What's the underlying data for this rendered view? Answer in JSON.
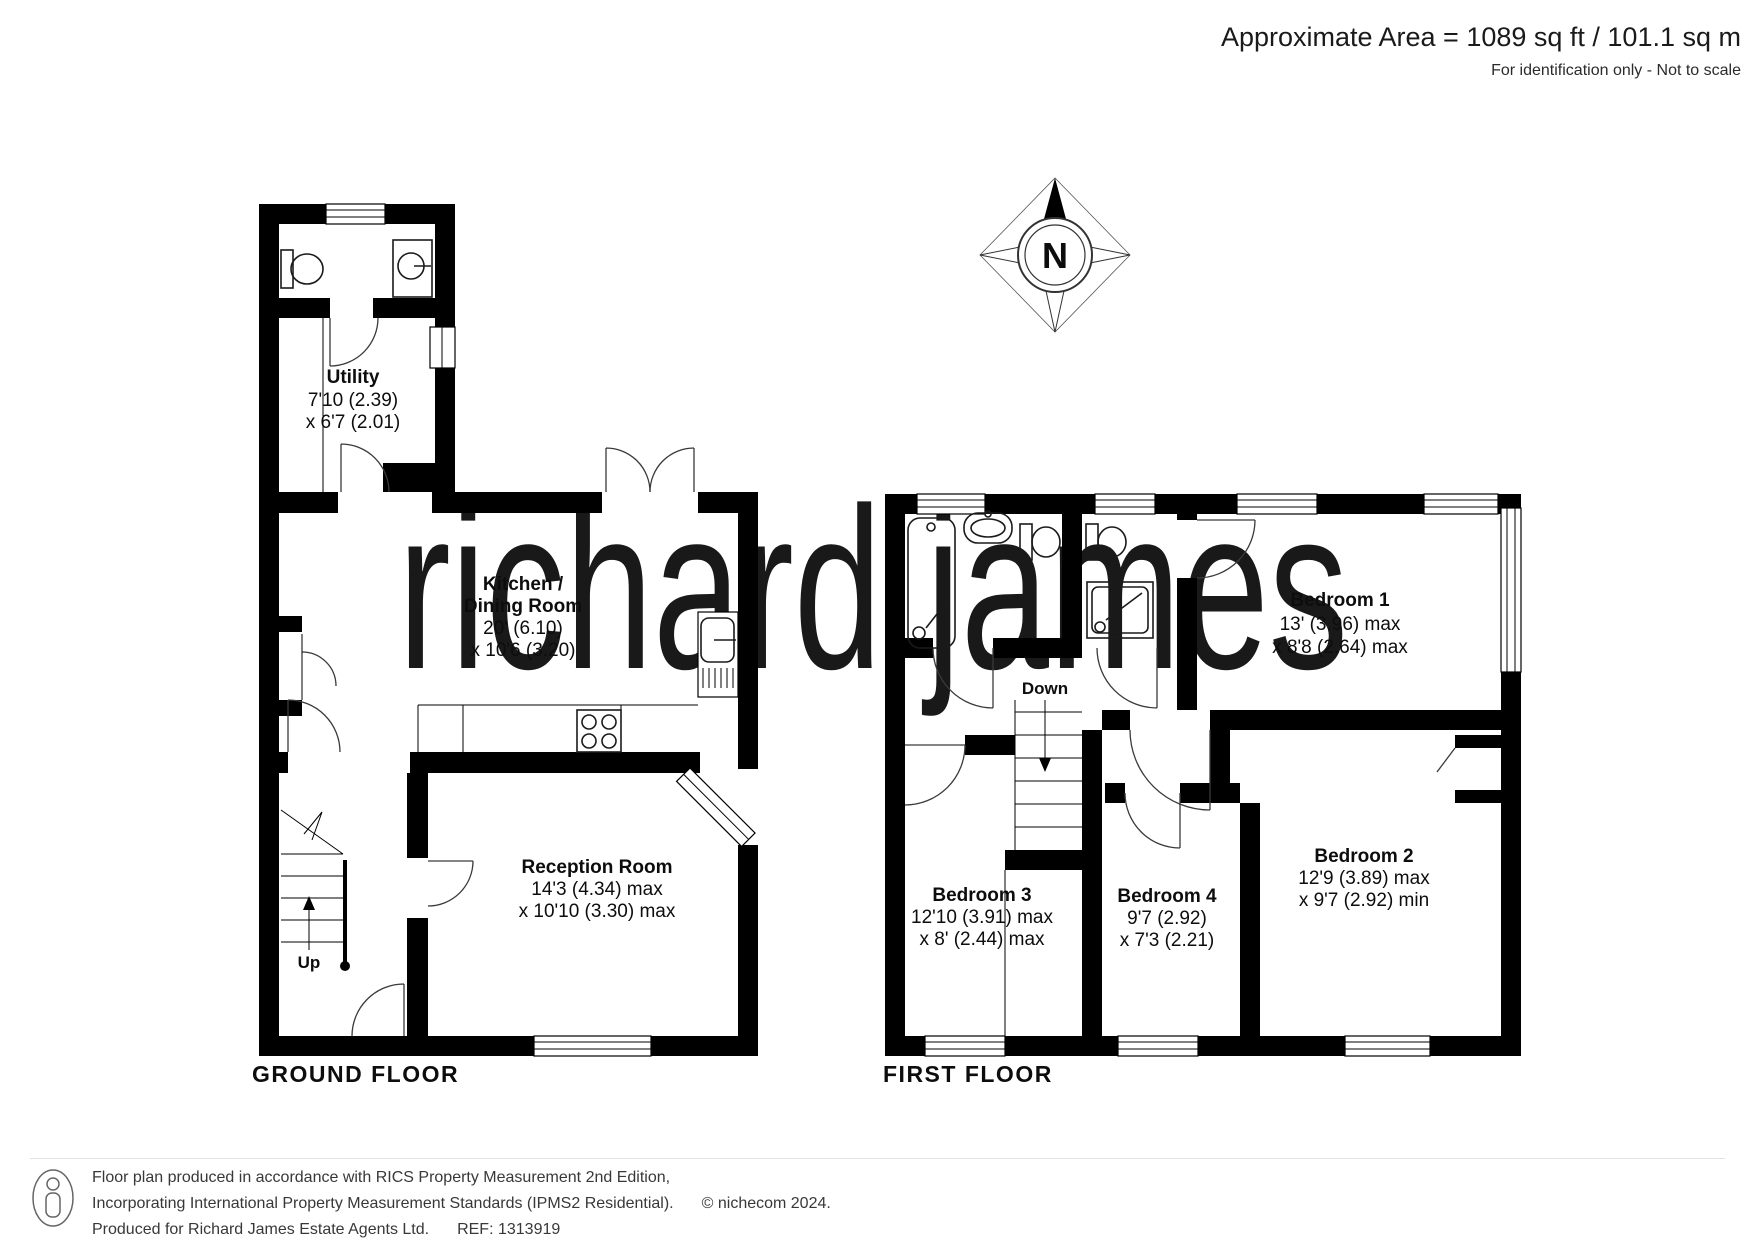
{
  "header": {
    "area": "Approximate Area = 1089 sq ft / 101.1 sq m",
    "note": "For identification only - Not to scale"
  },
  "compass": {
    "north": "N"
  },
  "watermark": {
    "text": "richard james"
  },
  "floors": {
    "ground": {
      "title": "GROUND FLOOR",
      "stairs_label": "Up",
      "rooms": {
        "utility": {
          "name": "Utility",
          "dim1": "7'10 (2.39)",
          "dim2": "x 6'7 (2.01)"
        },
        "kitchen": {
          "name1": "Kitchen /",
          "name2": "Dining Room",
          "dim1": "20' (6.10)",
          "dim2": "x 10'6 (3.20)"
        },
        "reception": {
          "name": "Reception Room",
          "dim1": "14'3 (4.34) max",
          "dim2": "x 10'10 (3.30) max"
        }
      }
    },
    "first": {
      "title": "FIRST FLOOR",
      "stairs_label": "Down",
      "rooms": {
        "bedroom1": {
          "name": "Bedroom 1",
          "dim1": "13' (3.96) max",
          "dim2": "x 8'8 (2.64) max"
        },
        "bedroom2": {
          "name": "Bedroom 2",
          "dim1": "12'9 (3.89) max",
          "dim2": "x 9'7 (2.92) min"
        },
        "bedroom3": {
          "name": "Bedroom 3",
          "dim1": "12'10 (3.91) max",
          "dim2": "x 8' (2.44) max"
        },
        "bedroom4": {
          "name": "Bedroom 4",
          "dim1": "9'7 (2.92)",
          "dim2": "x 7'3 (2.21)"
        }
      }
    }
  },
  "footer": {
    "line1": "Floor plan produced in accordance with RICS Property Measurement 2nd Edition,",
    "line2": "Incorporating International Property Measurement Standards (IPMS2 Residential).",
    "line2_suffix": "© nichecom 2024.",
    "line3": "Produced for Richard James Estate Agents Ltd.",
    "line3_suffix": "REF: 1313919"
  },
  "colors": {
    "wall": "#000000",
    "watermark": "#f4e6c6",
    "text": "#111111"
  }
}
